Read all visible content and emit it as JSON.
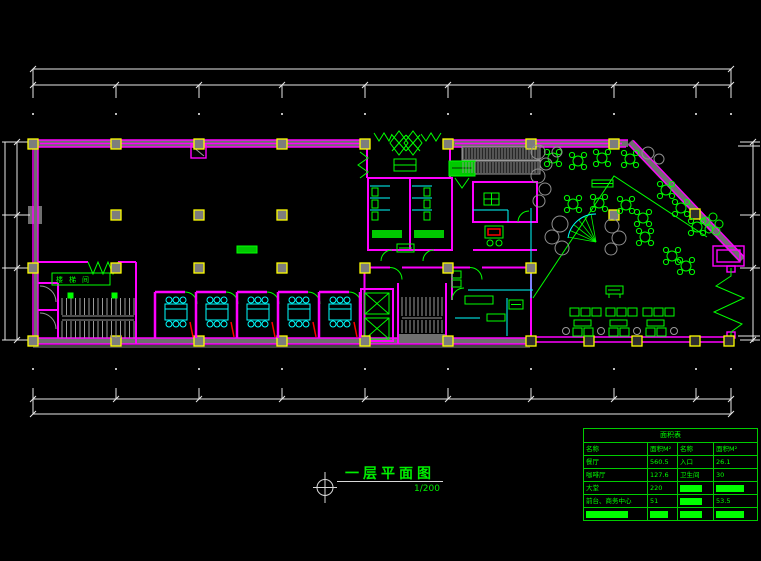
{
  "colors": {
    "background": "#000000",
    "wall": "#ff00ff",
    "annotation_green": "#00ff00",
    "fixture_cyan": "#00ffff",
    "column_yellow": "#ffff00",
    "dimension_white": "#e8e8e8",
    "structure_gray": "#6f6f6f",
    "door_red": "#ff0000"
  },
  "plan": {
    "title": "一层平面图",
    "scale": "1/200",
    "stair_label": "楼梯间"
  },
  "area_table": {
    "title": "面积表",
    "headers": [
      "名称",
      "面积M²",
      "名称",
      "面积M²"
    ],
    "rows": [
      [
        {
          "t": "餐厅"
        },
        {
          "t": "560.5"
        },
        {
          "t": "入口"
        },
        {
          "t": "26.1"
        }
      ],
      [
        {
          "t": "咖啡厅"
        },
        {
          "t": "127.6"
        },
        {
          "t": "卫生间"
        },
        {
          "t": "30"
        }
      ],
      [
        {
          "t": "大堂"
        },
        {
          "t": "220"
        },
        {
          "b": true
        },
        {
          "b": true
        }
      ],
      [
        {
          "t": "前台、商务中心"
        },
        {
          "t": "51"
        },
        {
          "b": true
        },
        {
          "t": "53.5"
        }
      ],
      [
        {
          "b": true
        },
        {
          "b": true
        },
        {
          "b": true
        },
        {
          "b": true
        }
      ]
    ]
  }
}
